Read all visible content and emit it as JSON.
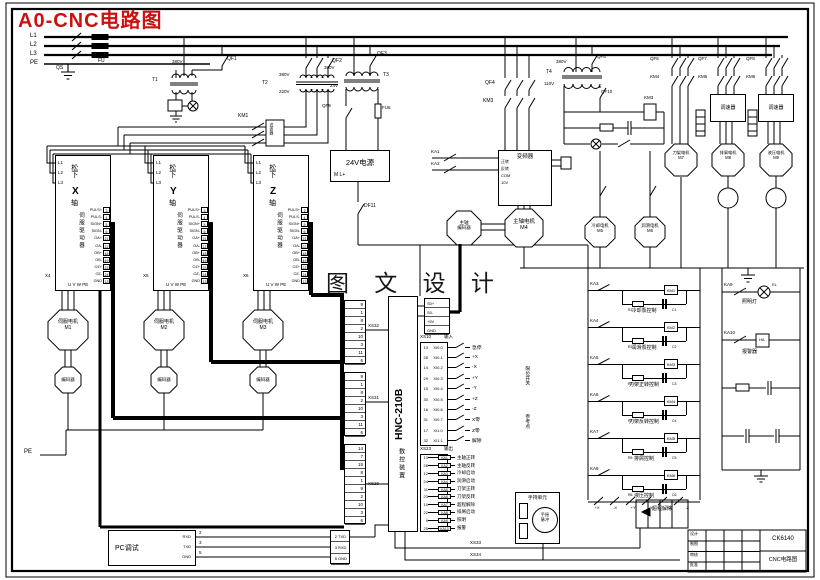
{
  "title": "A0-CNC电路图",
  "watermark": "图 文 设 计",
  "colors": {
    "title_red": "#cc1111",
    "line": "#000000"
  },
  "power": {
    "phases": [
      "L1",
      "L2",
      "L3",
      "PE"
    ],
    "qs": "QS",
    "fu": "FU",
    "t1": {
      "id": "T1",
      "v": "380V",
      "qf": "QF1"
    },
    "t2": {
      "id": "T2",
      "prim": "380V",
      "sec": "220V",
      "qf": "QF2",
      "km": "KM1",
      "filter": "滤波器"
    },
    "t3": {
      "id": "T3",
      "prim": "380V",
      "sec": "24V",
      "qf": "QF3",
      "sw": "QF9",
      "fu": "FU6"
    },
    "t4": {
      "id": "T4",
      "prim": "380V",
      "sec": "110V",
      "qf": "QF5",
      "qf2": "QF10",
      "coil": "KM3"
    },
    "psu": {
      "title": "24V电源",
      "pins": "M  L+",
      "sw": "DF11"
    }
  },
  "spindle": {
    "qf": "QF4",
    "km": "KM3",
    "vfd": "变频器",
    "vfd_pins": [
      "正转",
      "反转",
      "COM",
      "10V"
    ],
    "ka1": "KA1",
    "ka2": "KA2",
    "motor": {
      "name": "主轴电机",
      "id": "M4"
    },
    "enc1": "主轴",
    "enc2": "编码器"
  },
  "small_motors": [
    {
      "name": "冷却电机",
      "id": "M5"
    },
    {
      "name": "润滑电机",
      "id": "M6"
    }
  ],
  "branches": [
    {
      "qf": "QF6",
      "km": "KM4",
      "box": "",
      "motor": "刀架电机",
      "id": "M7"
    },
    {
      "qf": "QF7",
      "km": "KM5",
      "box": "调速器",
      "motor": "排屑电机",
      "id": "M8"
    },
    {
      "qf": "QF8",
      "km": "KM6",
      "box": "调速器",
      "motor": "液压电机",
      "id": "M9"
    }
  ],
  "drivers": {
    "brand": "松下",
    "suffix": "轴",
    "role": "伺服驱动器",
    "bottom": "U V W PE",
    "lpins": [
      "L1",
      "L2",
      "L3"
    ],
    "pins": [
      {
        "t": "PULS+",
        "n": "3"
      },
      {
        "t": "PULS-",
        "n": "4"
      },
      {
        "t": "SIGN+",
        "n": "5"
      },
      {
        "t": "SIGN-",
        "n": "6"
      },
      {
        "t": "OA+",
        "n": "21"
      },
      {
        "t": "OA-",
        "n": "22"
      },
      {
        "t": "OB+",
        "n": "48"
      },
      {
        "t": "OB-",
        "n": "49"
      },
      {
        "t": "OZ+",
        "n": "23"
      },
      {
        "t": "OZ-",
        "n": "24"
      },
      {
        "t": "GND",
        "n": "13"
      }
    ],
    "items": [
      {
        "axis": "X",
        "conn": "X4",
        "motor": "伺服电机",
        "id": "M1",
        "enc": "编码器"
      },
      {
        "axis": "Y",
        "conn": "X5",
        "motor": "伺服电机",
        "id": "M2",
        "enc": "编码器"
      },
      {
        "axis": "Z",
        "conn": "X6",
        "motor": "伺服电机",
        "id": "M3",
        "enc": "编码器"
      }
    ]
  },
  "cnc": {
    "model": "HNC-210B",
    "name": "数控装置",
    "xs32": {
      "label": "XS32",
      "pins": [
        "9",
        "1",
        "8",
        "2",
        "10",
        "3",
        "11",
        "6"
      ]
    },
    "xs31": {
      "label": "XS31",
      "pins": [
        "9",
        "1",
        "8",
        "2",
        "10",
        "3",
        "11",
        "6"
      ]
    },
    "xs20": {
      "label": "XS20",
      "pins": [
        "14",
        "7",
        "15",
        "8",
        "1",
        "9",
        "2",
        "10",
        "3",
        "6"
      ]
    },
    "xs9": {
      "pins": [
        "S0+",
        "S0-",
        "+5V",
        "GND"
      ]
    },
    "serial": {
      "pins": [
        {
          "n": "2",
          "t": "TXD"
        },
        {
          "n": "3",
          "t": "RXD"
        },
        {
          "n": "5",
          "t": "GND"
        }
      ]
    },
    "inputs": {
      "label": "XS10",
      "dir": "输入",
      "groups": {
        "limits": "限位开关",
        "ref": "参考点"
      },
      "rows": [
        {
          "n": "13",
          "code": "XI0.0",
          "sig": "急停"
        },
        {
          "n": "28",
          "code": "XI0.1",
          "sig": "+X"
        },
        {
          "n": "14",
          "code": "XI0.2",
          "sig": "-X"
        },
        {
          "n": "29",
          "code": "XI0.3",
          "sig": "+Y"
        },
        {
          "n": "15",
          "code": "XI0.4",
          "sig": "-Y"
        },
        {
          "n": "30",
          "code": "XI0.5",
          "sig": "+Z"
        },
        {
          "n": "16",
          "code": "XI0.6",
          "sig": "-Z"
        },
        {
          "n": "31",
          "code": "XI0.7",
          "sig": "X零"
        },
        {
          "n": "17",
          "code": "XI1.0",
          "sig": "Z零"
        },
        {
          "n": "32",
          "code": "XI1.1",
          "sig": "解除"
        }
      ]
    },
    "outputs": {
      "label": "XS23",
      "dir": "输出",
      "rows": [
        {
          "n": "13",
          "ka": "KA1",
          "sig": "主轴正转"
        },
        {
          "n": "28",
          "ka": "KA2",
          "sig": "主轴反转"
        },
        {
          "n": "12",
          "ka": "KA3",
          "sig": "冷却启动"
        },
        {
          "n": "24",
          "ka": "KA4",
          "sig": "润滑启动"
        },
        {
          "n": "11",
          "ka": "KA5",
          "sig": "刀架正转"
        },
        {
          "n": "23",
          "ka": "KA6",
          "sig": "刀架反转"
        },
        {
          "n": "10",
          "ka": "KA7",
          "sig": "超程解除"
        },
        {
          "n": "22",
          "ka": "KA8",
          "sig": "排屑启动"
        },
        {
          "n": "9",
          "ka": "KA9",
          "sig": "照明"
        },
        {
          "n": "25",
          "ka": "KA10",
          "sig": "报警"
        }
      ]
    },
    "xs33": "XS33",
    "xs34": "XS34"
  },
  "ladder": {
    "rungs": [
      {
        "c": "KA3",
        "coil": "KM1",
        "r": "R1",
        "cap": "C1",
        "label": "冷却泵控制"
      },
      {
        "c": "KA4",
        "coil": "KM2",
        "r": "R2",
        "cap": "C2",
        "label": "润滑泵控制"
      },
      {
        "c": "KA5",
        "coil": "KM3",
        "r": "R3",
        "cap": "C3",
        "label": "刀架正转控制"
      },
      {
        "c": "KA6",
        "coil": "KM4",
        "r": "R4",
        "cap": "C4",
        "label": "刀架反转控制"
      },
      {
        "c": "KA7",
        "coil": "KM5",
        "r": "R5",
        "cap": "C5",
        "label": "排屑控制"
      },
      {
        "c": "KA8",
        "coil": "KM6",
        "r": "R6",
        "cap": "C6",
        "label": "液压控制"
      }
    ],
    "ot": [
      "+X",
      "-X",
      "+Y",
      "-Y",
      "+Z",
      "-Z"
    ],
    "ot_label": "超程解除"
  },
  "aux": {
    "rungs": [
      {
        "c": "KA9",
        "dev": "EL",
        "label": "照明灯"
      },
      {
        "c": "KA10",
        "dev": "HA",
        "label": "报警器"
      }
    ]
  },
  "pc": {
    "title": "PC调试",
    "pins": [
      "RXD",
      "TXD",
      "GND"
    ],
    "nums": [
      "2",
      "3",
      "5"
    ]
  },
  "pendant": {
    "title": "手持单元",
    "wheel": [
      "手摇",
      "脉冲"
    ]
  },
  "pe": "PE",
  "titleblock": {
    "rows": [
      "设计",
      "制图",
      "审核",
      "批准"
    ],
    "code": "CK6140",
    "name": "CNC电路图"
  }
}
